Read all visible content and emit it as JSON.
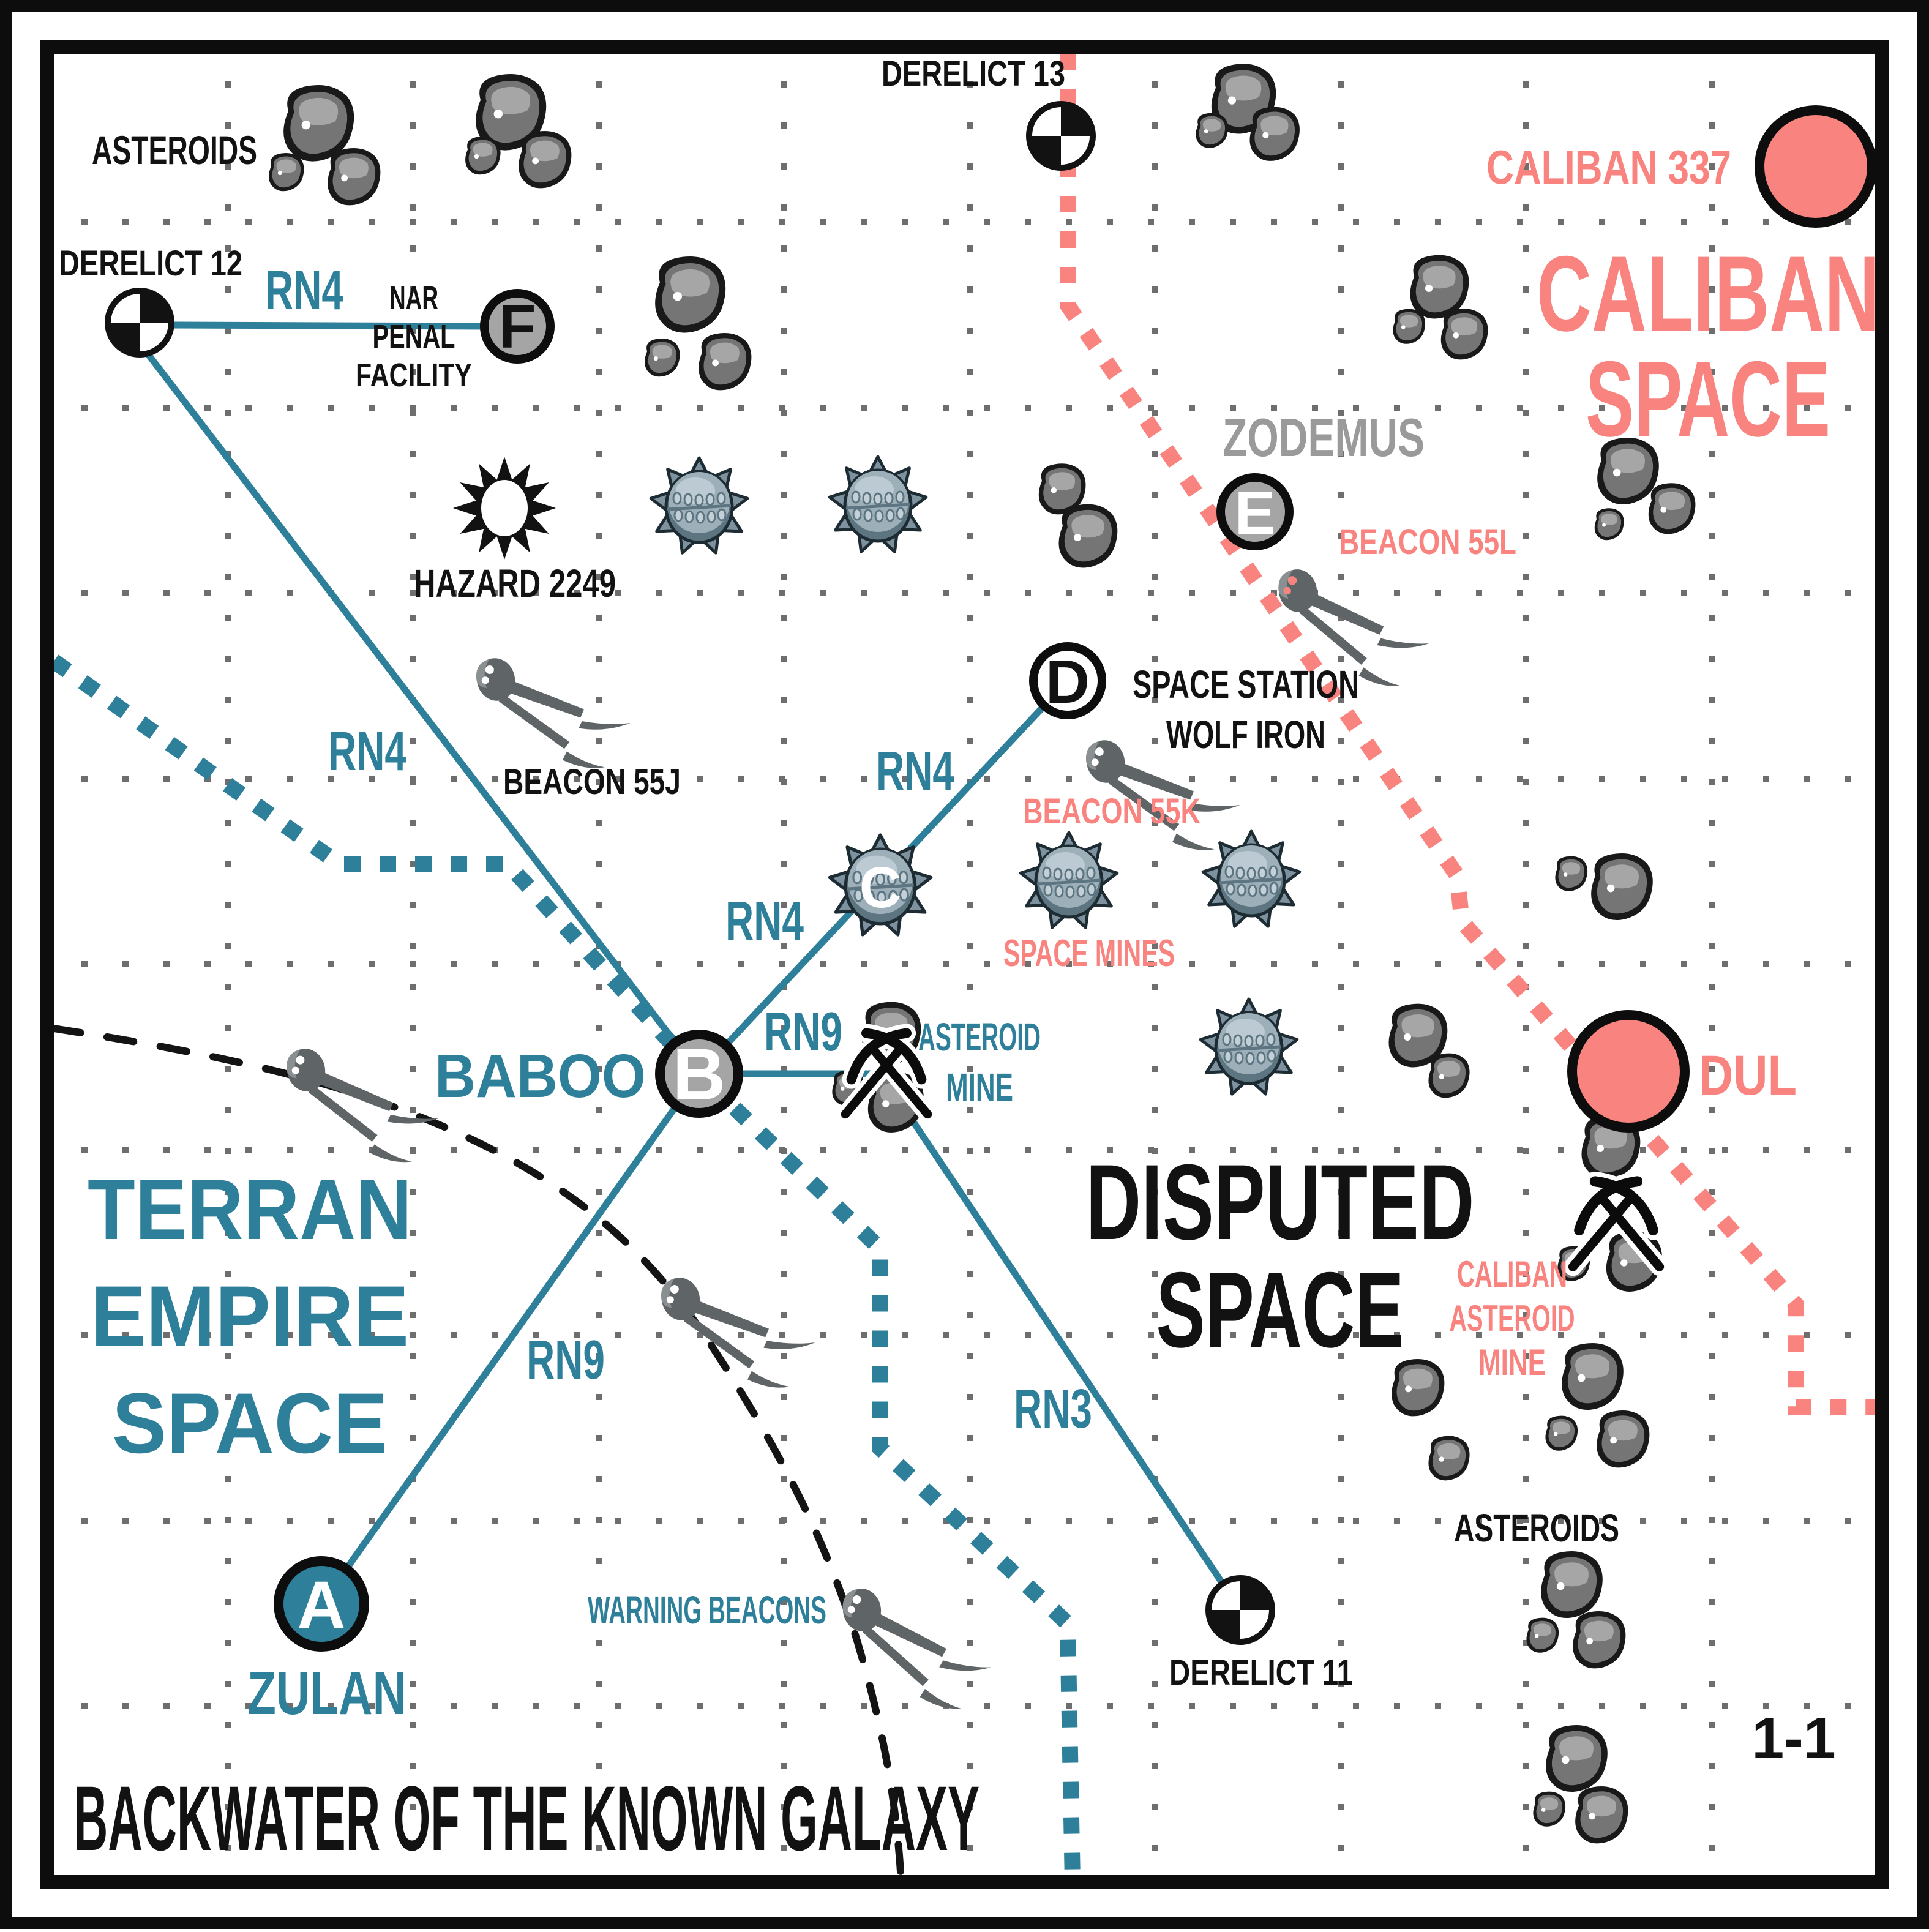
{
  "map": {
    "footer_title": "BACKWATER OF THE KNOWN GALAXY",
    "page_marker": "1-1"
  },
  "regions": {
    "terran": {
      "lines": [
        "TERRAN",
        "EMPIRE",
        "SPACE"
      ],
      "color": "#2e7f9a"
    },
    "disputed": {
      "lines": [
        "DISPUTED",
        "SPACE"
      ],
      "color": "#121212"
    },
    "caliban": {
      "lines": [
        "CALIBAN",
        "SPACE"
      ],
      "color": "#f9837f"
    }
  },
  "planets": [
    {
      "name": "CALIBAN 337"
    },
    {
      "name": "DUL"
    }
  ],
  "systems": [
    {
      "letter": "A",
      "name": "ZULAN"
    },
    {
      "letter": "B",
      "name": "BABOO"
    },
    {
      "letter": "C",
      "name": ""
    },
    {
      "letter": "D",
      "name_lines": [
        "SPACE STATION",
        "WOLF IRON"
      ]
    },
    {
      "letter": "E",
      "name": "ZODEMUS"
    },
    {
      "letter": "F",
      "name_lines": [
        "NAR",
        "PENAL",
        "FACILITY"
      ]
    }
  ],
  "derelicts": [
    {
      "name": "DERELICT 11"
    },
    {
      "name": "DERELICT 12"
    },
    {
      "name": "DERELICT 13"
    }
  ],
  "beacons": [
    {
      "name": "BEACON 55J"
    },
    {
      "name": "BEACON 55K"
    },
    {
      "name": "BEACON 55L"
    }
  ],
  "routes": {
    "rn3": "RN3",
    "rn4": "RN4",
    "rn9": "RN9"
  },
  "hazards": {
    "hazard_label": "HAZARD 2249",
    "space_mines_label": "SPACE MINES",
    "warning_beacons_label": "WARNING BEACONS"
  },
  "mines": {
    "asteroid_mine_lines": [
      "ASTEROID",
      "MINE"
    ],
    "caliban_mine_lines": [
      "CALIBAN",
      "ASTEROID",
      "MINE"
    ]
  },
  "asteroid_labels": {
    "top_left": "ASTEROIDS",
    "bottom_right": "ASTEROIDS"
  },
  "colors": {
    "teal": "#2e7f9a",
    "pink": "#f9837f",
    "gray_label": "#9a9a9a",
    "node_gray": "#a5a5a5",
    "grid_dot": "#6e6e6e",
    "ink": "#121212"
  }
}
